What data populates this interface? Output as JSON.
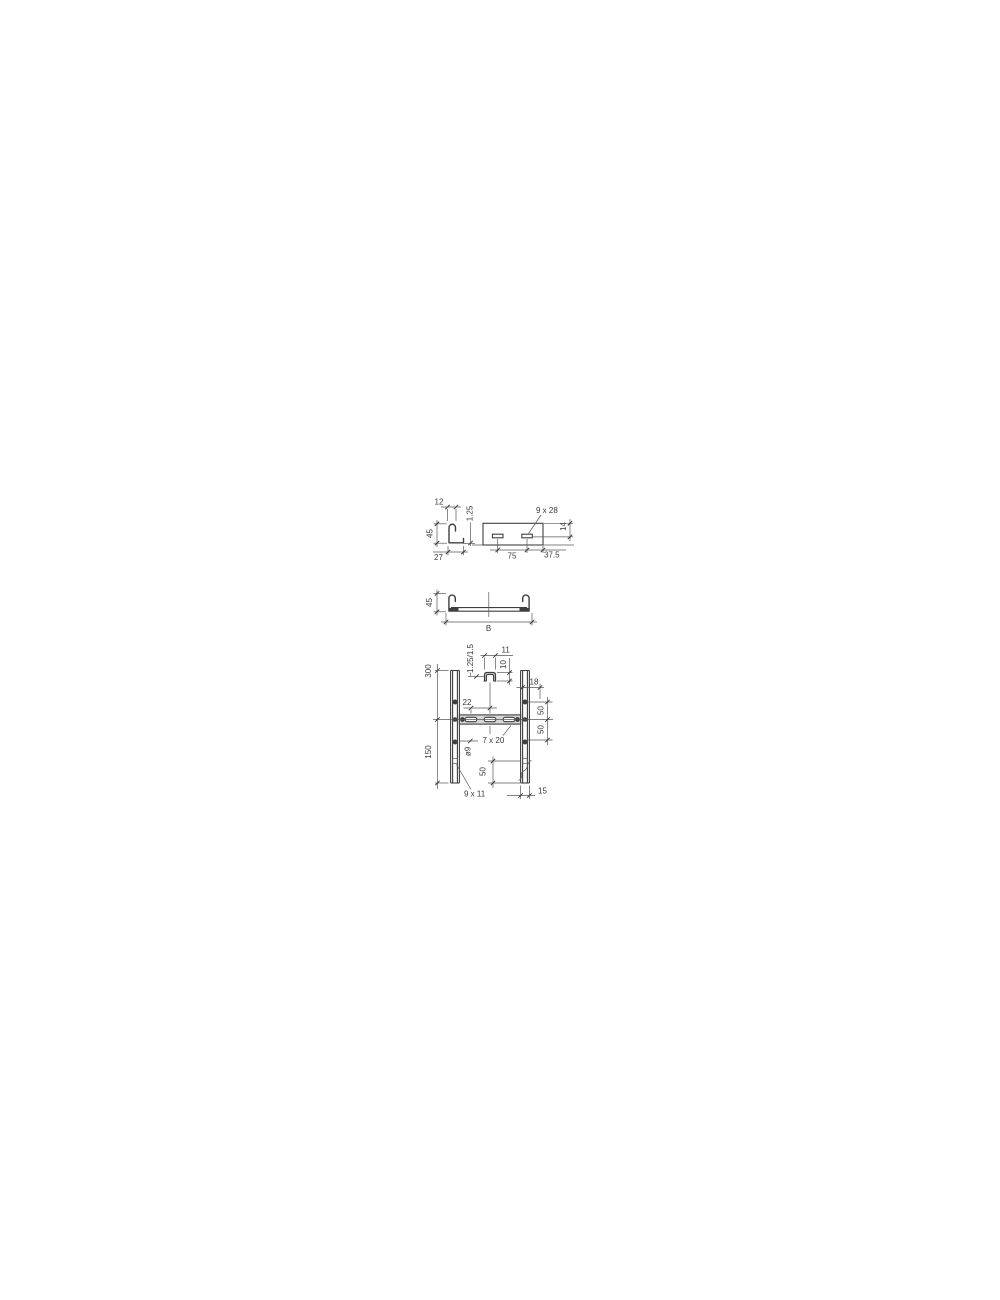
{
  "drawing": {
    "background": "#ffffff",
    "line_color": "#3f3f3f",
    "rung_fill": "#d8d8d8",
    "description": "cable-ladder dimension drawing with four views",
    "views": {
      "rail_profile": {
        "name": "side-rail profile section",
        "dim_hook_width": "12",
        "dim_thickness": "1.25",
        "dim_height": "45",
        "dim_flange_width": "27"
      },
      "rail_elevation": {
        "name": "side-rail elevation with slots",
        "dim_slot_size": "9 x 28",
        "dim_slot_height": "14",
        "dim_slot_pitch": "75",
        "dim_slot_end_offset": "37.5"
      },
      "cross_section": {
        "name": "ladder cross-section",
        "dim_height": "45",
        "dim_width": "B"
      },
      "plan": {
        "name": "ladder plan view",
        "dim_rung_pitch": "300",
        "dim_end_length": "150",
        "dim_rung_thickness": "1.25/1.5",
        "dim_rung_width": "11",
        "dim_rung_height": "10",
        "dim_slot_pitch": "22",
        "dim_flange": "18",
        "dim_hole_pitch_1": "50",
        "dim_hole_pitch_2": "50",
        "dim_rung_slot": "7 x 20",
        "dim_hole_dia": "ø9",
        "dim_end_hole_offset": "50",
        "dim_end_slot": "9 x 11",
        "dim_rail_width": "15"
      }
    }
  }
}
